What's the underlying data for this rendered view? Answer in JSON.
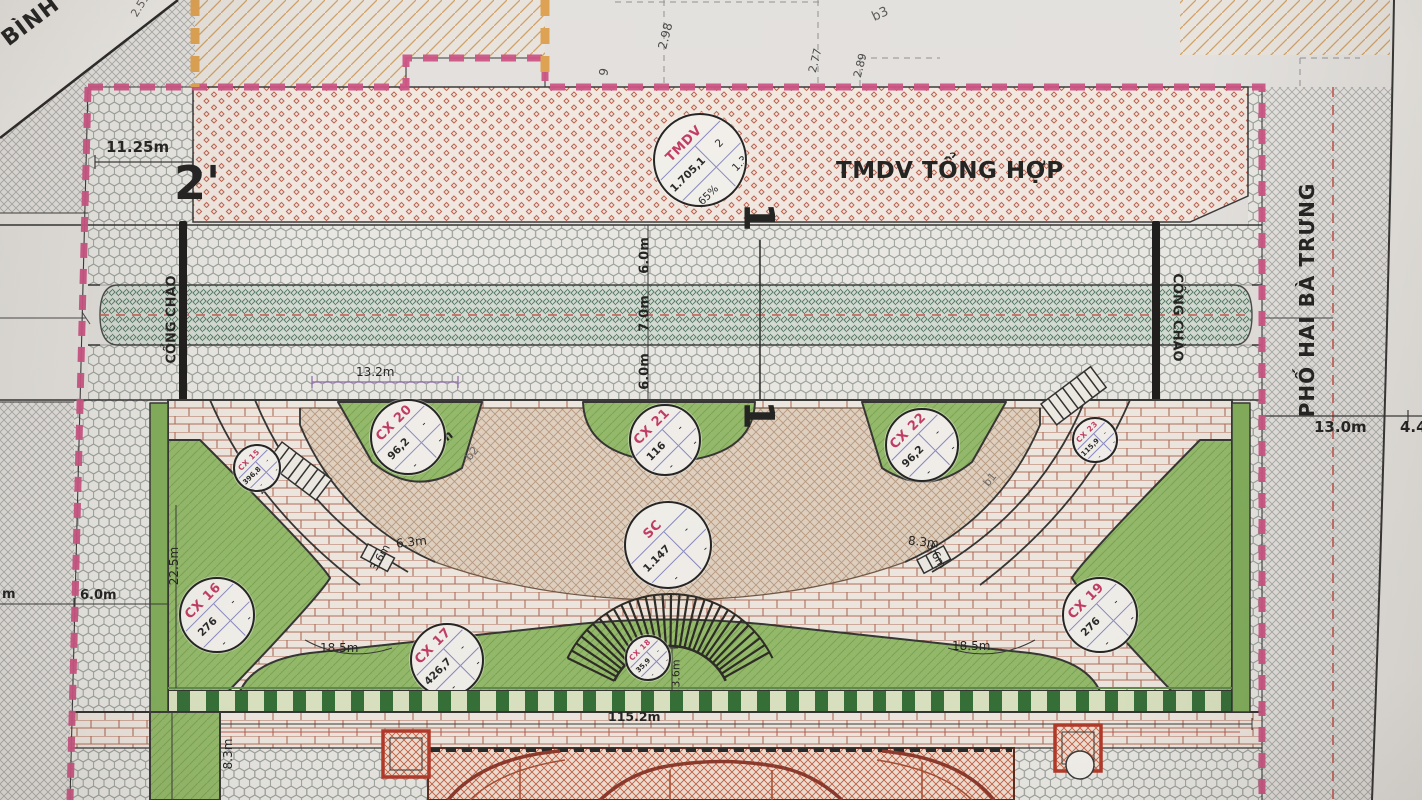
{
  "drawing": {
    "streets": {
      "left_fragment": "ÁI BÌNH",
      "right": "PHỐ HAI BÀ TRƯNG"
    },
    "zones": {
      "tmdv_title": "TMDV TỔNG HỢP",
      "gate_left": "CỔNG CHÀO",
      "gate_right": "CỔNG CHÀO"
    },
    "section_marks": {
      "left": "2'",
      "top": "1",
      "bottom": "1"
    },
    "circles": {
      "tmdv": {
        "code": "TMDV",
        "value": "1.705,1",
        "cell_tr": "2",
        "cell_bl": "65%",
        "cell_br": "1.3"
      },
      "cx15": {
        "code": "CX 15",
        "value": "396,8",
        "cell_tr": "-",
        "cell_bl": "-",
        "cell_br": "-"
      },
      "cx16": {
        "code": "CX 16",
        "value": "276",
        "cell_tr": "-",
        "cell_bl": "-",
        "cell_br": "-"
      },
      "cx17": {
        "code": "CX 17",
        "value": "426,7",
        "cell_tr": "-",
        "cell_bl": "-",
        "cell_br": "-"
      },
      "cx18": {
        "code": "CX 18",
        "value": "35,9",
        "cell_tr": "-",
        "cell_bl": "-",
        "cell_br": "-"
      },
      "cx19": {
        "code": "CX 19",
        "value": "276",
        "cell_tr": "-",
        "cell_bl": "-",
        "cell_br": "-"
      },
      "cx20": {
        "code": "CX 20",
        "value": "96,2",
        "cell_tr": "-",
        "cell_bl": "-",
        "cell_br": "-"
      },
      "cx21": {
        "code": "CX 21",
        "value": "116",
        "cell_tr": "-",
        "cell_bl": "-",
        "cell_br": "-"
      },
      "cx22": {
        "code": "CX 22",
        "value": "96,2",
        "cell_tr": "-",
        "cell_bl": "-",
        "cell_br": "-"
      },
      "cx23": {
        "code": "CX 23",
        "value": "115,9",
        "cell_tr": "-",
        "cell_bl": "-",
        "cell_br": "-"
      },
      "sc": {
        "code": "SC",
        "value": "1.147",
        "cell_tr": "-",
        "cell_bl": "-",
        "cell_br": "-"
      }
    },
    "dimensions": {
      "d251": "2.51",
      "d1125": "11.25m",
      "d298": "2.98",
      "d277": "2.77",
      "d289": "2.89",
      "d9": "9",
      "b3": "b3",
      "b2": "b2",
      "b1": "b1",
      "road_top": "6.0m",
      "road_mid": "7.0m",
      "road_bot": "6.0m",
      "d132": "13.2m",
      "d60_cx20": "6.0m",
      "d26": "2.6m",
      "d63": "6.3m",
      "d83_right": "8.3m",
      "d36_left": "3.6m",
      "d36_right": "3.6m",
      "d36_center": "3.6m",
      "d225": "22.5m",
      "d185_left": "18.5m",
      "d185_right": "18.5m",
      "d1152": "115.2m",
      "d83_bottom": "8.3m",
      "d60_left": "6.0m",
      "dm_fragment": "m",
      "d130": "13.0m",
      "d44": "4.4"
    },
    "colors": {
      "boundary_pink": "#cc4f82",
      "boundary_orange": "#dfa04e",
      "lawn_green": "#92ba68",
      "road_band_green": "#d3dcd4",
      "tmdv_hatch_red": "#bc5f4c",
      "brick_joint": "#b06a55",
      "centerline_red": "#c2544b"
    }
  }
}
